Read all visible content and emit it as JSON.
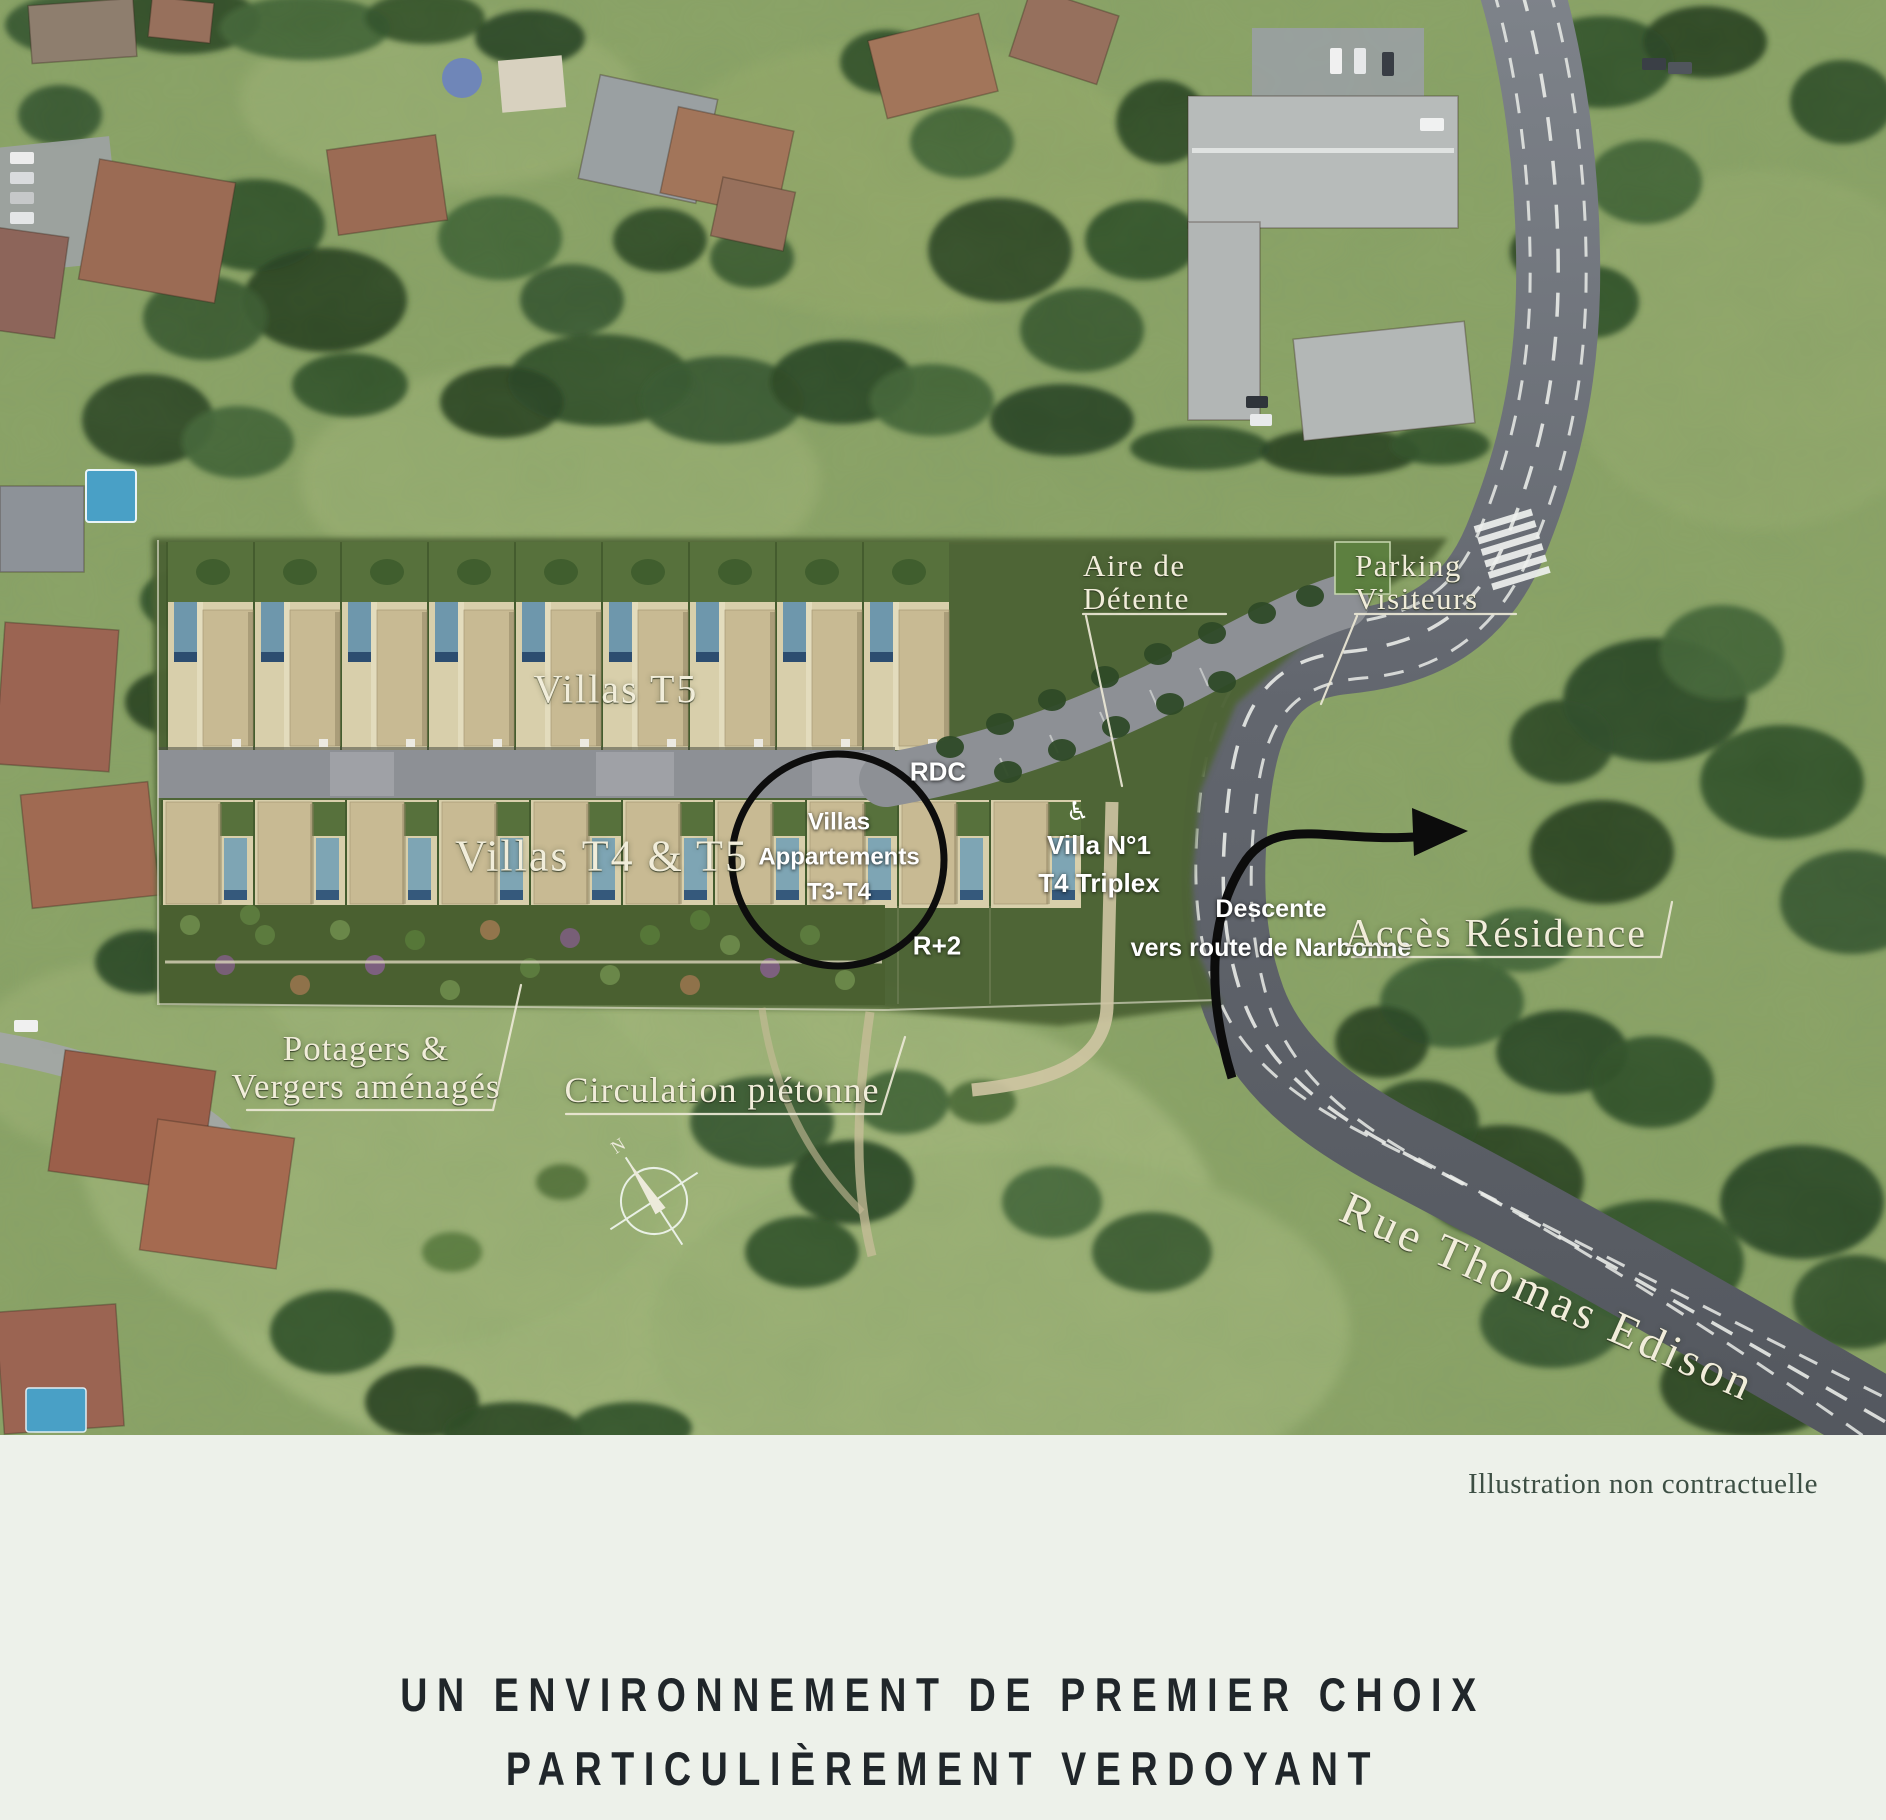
{
  "map": {
    "labels": {
      "aire_detente": {
        "line1": "Aire de",
        "line2": "Détente"
      },
      "parking": {
        "line1": "Parking",
        "line2": "Visiteurs"
      },
      "villas_t5": "Villas T5",
      "villas_t4_t5": "Villas T4 & T5",
      "circle_callout": {
        "line1": "Villas",
        "line2": "Appartements",
        "line3": "T3-T4"
      },
      "rdc": "RDC",
      "r_plus_2": "R+2",
      "villa_n1": {
        "line1": "Villa N°1",
        "line2": "T4 Triplex"
      },
      "descente": {
        "line1": "Descente",
        "line2": "vers route de Narbonne"
      },
      "acces_residence": "Accès Résidence",
      "potagers": {
        "line1": "Potagers &",
        "line2": "Vergers aménagés"
      },
      "circulation": "Circulation piétonne",
      "rue_thomas_edison": "Rue Thomas Edison",
      "compass_n": "N",
      "handicap_icon": "♿"
    },
    "colors": {
      "overlay_green": "#4e6434",
      "road_gray": "#8d9095",
      "asphalt_dark": "#5a5f67",
      "roof_tan": "#c8ba93",
      "pool_blue": "#6e97ac",
      "label_cream": "#f1edda",
      "label_white": "#ffffff",
      "annotation_black": "#0d0d0d",
      "footer_bg": "#edf1ea",
      "footer_text": "#3d4f44",
      "title_color": "#20262a"
    }
  },
  "footer": {
    "note": "Illustration non contractuelle",
    "title_line1": "UN ENVIRONNEMENT DE PREMIER CHOIX",
    "title_line2": "PARTICULIÈREMENT VERDOYANT"
  }
}
